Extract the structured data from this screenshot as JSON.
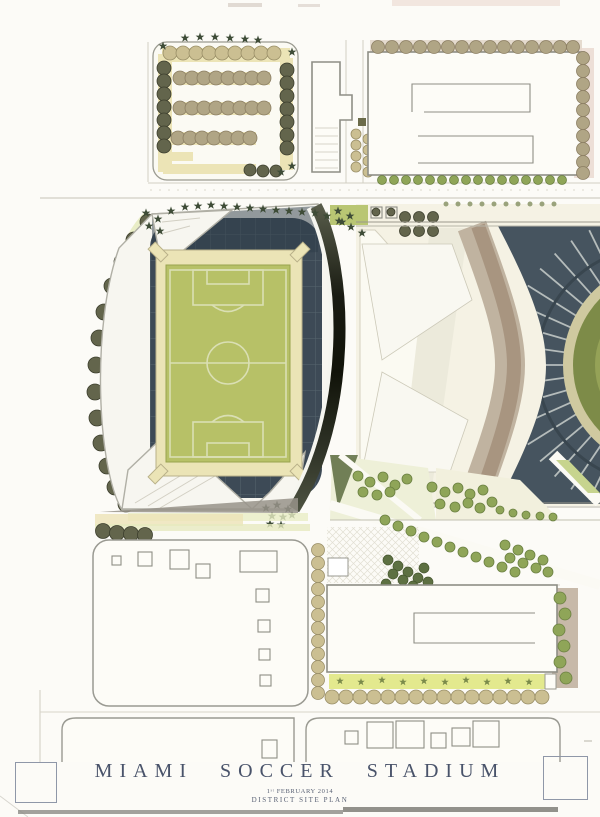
{
  "title_block": {
    "title": "MIAMI SOCCER STADIUM",
    "date_line": "1ˢᵗ FEBRUARY 2014",
    "plan_type": "DISTRICT SITE PLAN"
  },
  "palette": {
    "page": "#fcfbf7",
    "line": "#8e8e86",
    "roof_white": "#f7f6f0",
    "bowl_dark": "#3d4a56",
    "bowl_line": "#57656f",
    "concourse_cream": "#ebe4b6",
    "field_green": "#b7c167",
    "field_line": "#dadfb4",
    "tree_olive": "#63654c",
    "tree_tan": "#cbbf92",
    "tree_green": "#8fa558",
    "tree_dark": "#3e4c37",
    "crescent_dark": "#1c1e15",
    "band_brown": "#a5917c",
    "exist_bowl": "#46545f",
    "exist_field": "#7d8b48",
    "plaza_green": "#e3e7bb",
    "strip_yellow": "#e3e98e",
    "pink_tint": "#e9d6cc",
    "tan_paving": "#ece4b6",
    "title_text": "#49536a"
  }
}
